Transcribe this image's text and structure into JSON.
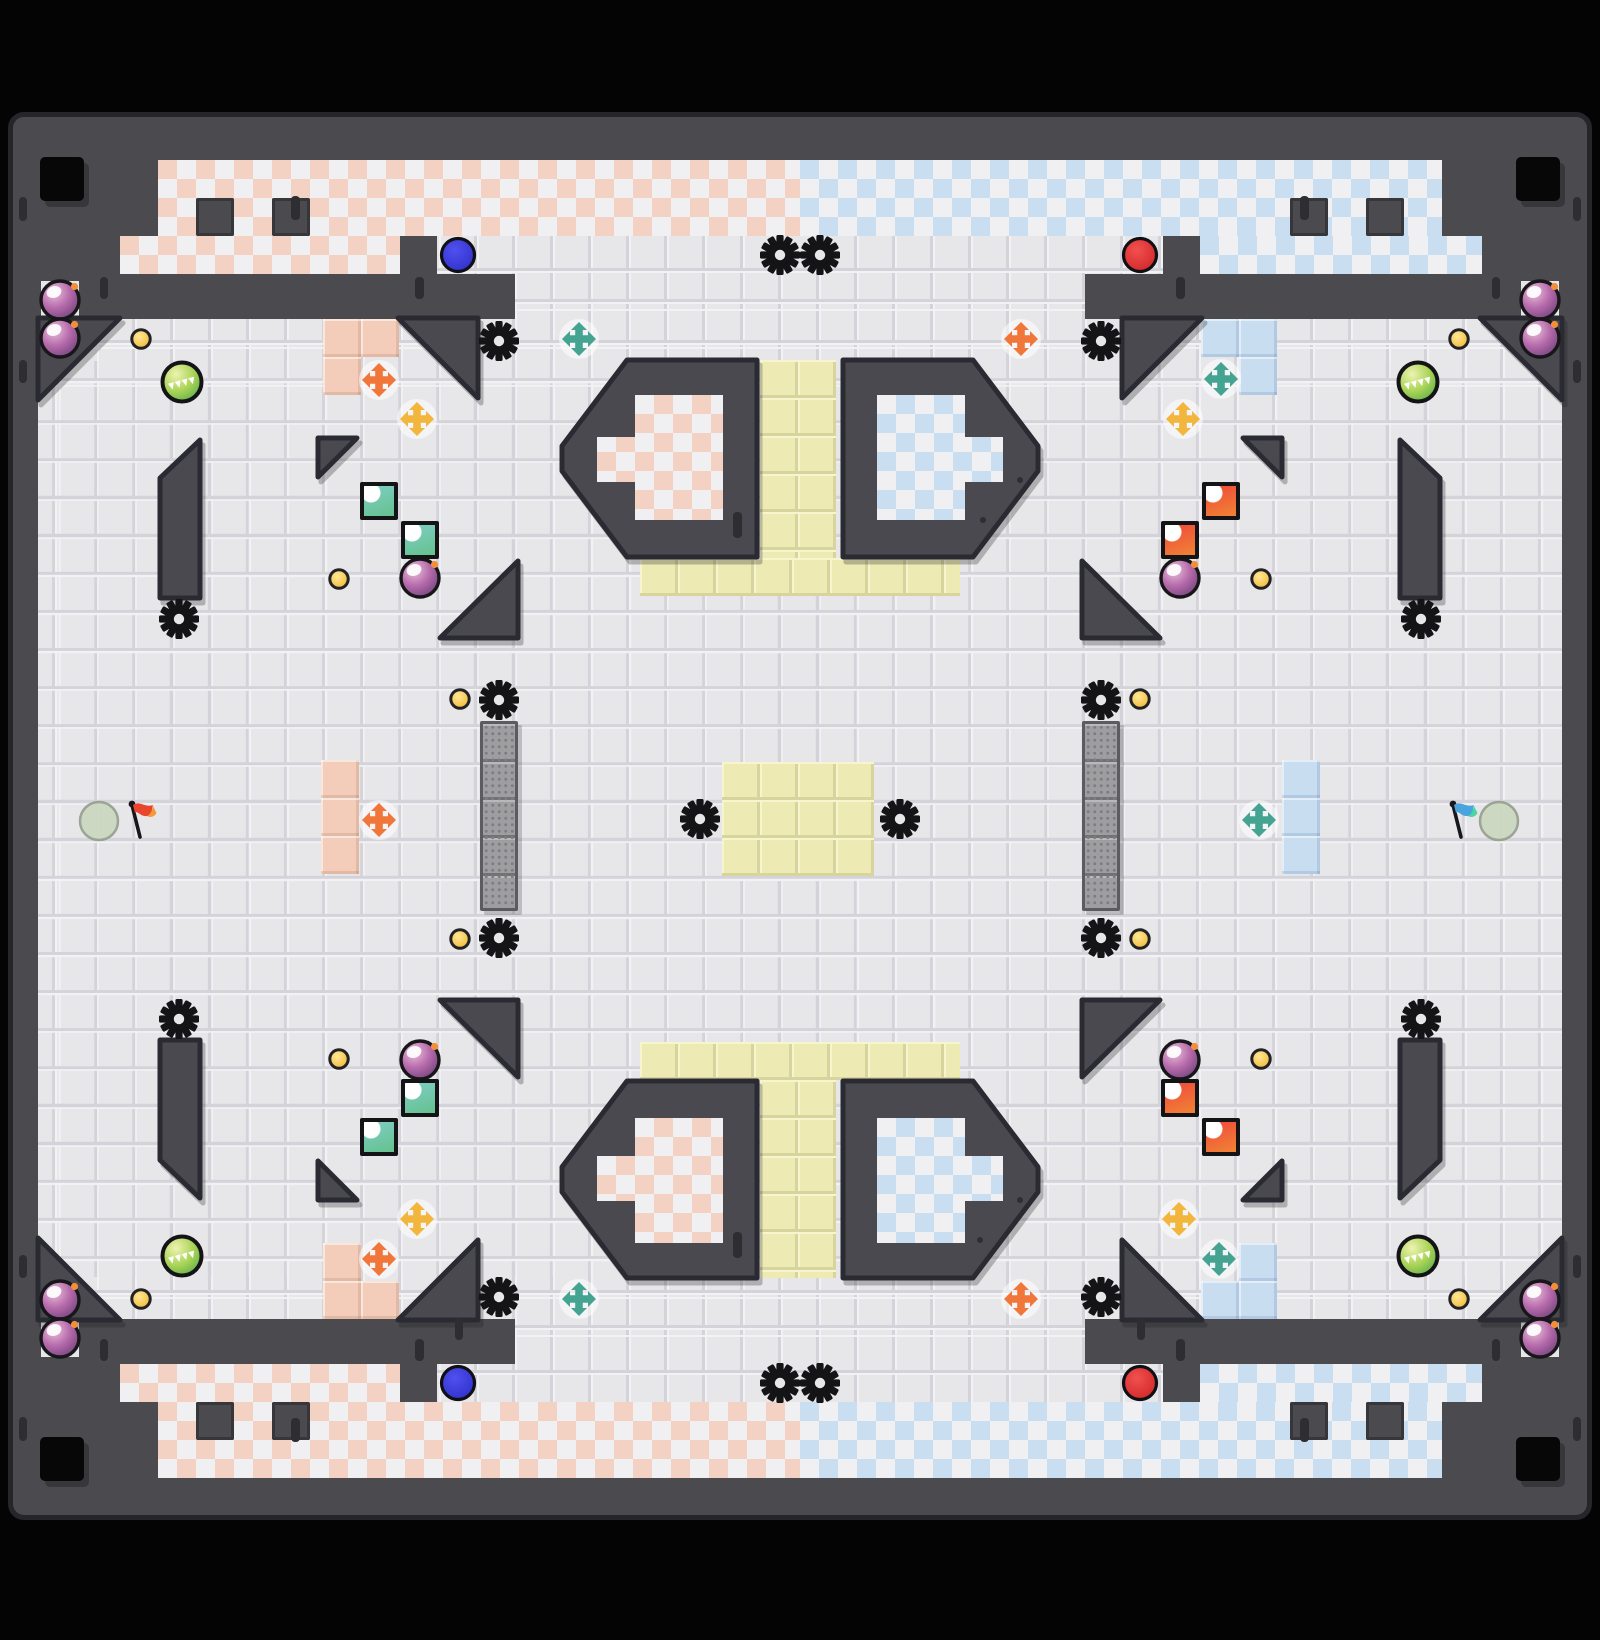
{
  "meta": {
    "app": "tile-arena-game-map",
    "canvas_w": 1600,
    "canvas_h": 1640
  },
  "palette": {
    "background": "#040404",
    "wall": "#4a4a4f",
    "wall_edge": "#2c2c31",
    "floor": "#e7e7ea",
    "checker_pink": "#f3d2c3",
    "checker_blue": "#cadef1",
    "solid_pink": "#f3cdb9",
    "solid_blue": "#c9ddf0",
    "yellow_pad": "#edeab3",
    "gate_gray": "#9e9ea1",
    "portal_blue": "#3a3ad6",
    "portal_red": "#e22b2b",
    "boost_orange": "#f0763a",
    "boost_yellow": "#f2b63c",
    "boost_teal": "#45a392",
    "bomb_purple": "#a05fa0",
    "button_yellow": "#f3b82d",
    "powerup_green": "#58b54a",
    "flag_red": "#e8452c",
    "flag_blue": "#4aa4dd",
    "spawn_pale": "#ccd8c0"
  },
  "frame": {
    "x": 8,
    "y": 112,
    "w": 1584,
    "h": 1408
  },
  "floors": [
    [
      437,
      236,
      726,
      38
    ],
    [
      515,
      274,
      570,
      45
    ],
    [
      80,
      319,
      1440,
      42
    ],
    [
      38,
      361,
      1524,
      916
    ],
    [
      80,
      1277,
      1440,
      42
    ],
    [
      515,
      1319,
      570,
      45
    ],
    [
      437,
      1364,
      726,
      38
    ],
    [
      41,
      281,
      38,
      76
    ],
    [
      1521,
      281,
      38,
      76
    ],
    [
      41,
      1281,
      38,
      76
    ],
    [
      1521,
      1281,
      38,
      76
    ]
  ],
  "checker_pink": [
    [
      158,
      160,
      642,
      76
    ],
    [
      120,
      236,
      280,
      38
    ],
    [
      158,
      1402,
      642,
      76
    ],
    [
      120,
      1364,
      280,
      38
    ]
  ],
  "checker_blue": [
    [
      800,
      160,
      642,
      76
    ],
    [
      1200,
      236,
      282,
      38
    ],
    [
      800,
      1402,
      642,
      76
    ],
    [
      1200,
      1364,
      282,
      38
    ]
  ],
  "band_holes": [
    [
      196,
      198
    ],
    [
      272,
      198
    ],
    [
      1290,
      198
    ],
    [
      1366,
      198
    ],
    [
      196,
      1402
    ],
    [
      272,
      1402
    ],
    [
      1290,
      1402
    ],
    [
      1366,
      1402
    ]
  ],
  "solid_pink": [
    [
      323,
      319,
      76,
      38
    ],
    [
      323,
      357,
      38,
      38
    ],
    [
      321,
      760,
      38,
      114
    ],
    [
      323,
      1281,
      76,
      38
    ],
    [
      323,
      1243,
      38,
      38
    ]
  ],
  "solid_blue": [
    [
      1201,
      319,
      76,
      38
    ],
    [
      1239,
      357,
      38,
      38
    ],
    [
      1282,
      760,
      38,
      114
    ],
    [
      1201,
      1281,
      76,
      38
    ],
    [
      1239,
      1243,
      38,
      38
    ]
  ],
  "yellow_pads": [
    [
      760,
      360,
      76,
      198
    ],
    [
      640,
      558,
      320,
      38
    ],
    [
      722,
      762,
      152,
      114
    ],
    [
      640,
      1042,
      320,
      38
    ],
    [
      760,
      1080,
      76,
      198
    ]
  ],
  "gray_gates": [
    [
      480,
      721,
      38,
      190
    ],
    [
      1082,
      721,
      38,
      190
    ]
  ],
  "corner_squares": [
    [
      40,
      157
    ],
    [
      1516,
      157
    ],
    [
      40,
      1437
    ],
    [
      1516,
      1437
    ]
  ],
  "wall_shapes": [
    {
      "name": "hexagon-top-left",
      "d": "M627,360 L757,360 L757,557 L627,557 L562,471 L562,446 Z"
    },
    {
      "name": "hexagon-top-right",
      "d": "M973,360 L843,360 L843,557 L973,557 L1038,471 L1038,446 Z"
    },
    {
      "name": "hexagon-bottom-left",
      "d": "M627,1278 L757,1278 L757,1081 L627,1081 L562,1167 L562,1192 Z"
    },
    {
      "name": "hexagon-bottom-right",
      "d": "M973,1278 L843,1278 L843,1081 L973,1081 L1038,1167 L1038,1192 Z"
    },
    {
      "name": "pillar-top-left",
      "d": "M160,478 L200,440 L200,598 L160,598 Z"
    },
    {
      "name": "pillar-top-right",
      "d": "M1440,478 L1400,440 L1400,598 L1440,598 Z"
    },
    {
      "name": "pillar-bottom-left",
      "d": "M160,1160 L200,1198 L200,1040 L160,1040 Z"
    },
    {
      "name": "pillar-bottom-right",
      "d": "M1440,1160 L1400,1198 L1400,1040 L1440,1040 Z"
    },
    {
      "name": "wedge-corridor-top-left",
      "d": "M398,318 L478,318 L478,398 Z"
    },
    {
      "name": "wedge-corridor-top-right",
      "d": "M1202,318 L1122,318 L1122,398 Z"
    },
    {
      "name": "wedge-corridor-bottom-left",
      "d": "M398,1320 L478,1320 L478,1240 Z"
    },
    {
      "name": "wedge-corridor-bottom-right",
      "d": "M1202,1320 L1122,1320 L1122,1240 Z"
    },
    {
      "name": "wedge-stair-large-top-left",
      "d": "M440,638 L518,561 L518,638 Z"
    },
    {
      "name": "wedge-stair-large-top-right",
      "d": "M1160,638 L1082,561 L1082,638 Z"
    },
    {
      "name": "wedge-stair-large-bottom-left",
      "d": "M440,1000 L518,1077 L518,1000 Z"
    },
    {
      "name": "wedge-stair-large-bottom-right",
      "d": "M1160,1000 L1082,1077 L1082,1000 Z"
    },
    {
      "name": "wedge-stair-small-top-left",
      "d": "M318,438 L357,438 L318,477 Z"
    },
    {
      "name": "wedge-stair-small-top-right",
      "d": "M1282,438 L1243,438 L1282,477 Z"
    },
    {
      "name": "wedge-stair-small-bottom-left",
      "d": "M318,1200 L318,1161 L357,1200 Z"
    },
    {
      "name": "wedge-stair-small-bottom-right",
      "d": "M1282,1200 L1282,1161 L1243,1200 Z"
    },
    {
      "name": "corner-diagonal-top-left",
      "d": "M38,318 L120,318 L38,400 Z"
    },
    {
      "name": "corner-diagonal-top-right",
      "d": "M1562,318 L1480,318 L1562,400 Z"
    },
    {
      "name": "corner-diagonal-bottom-left",
      "d": "M38,1320 L120,1320 L38,1238 Z"
    },
    {
      "name": "corner-diagonal-bottom-right",
      "d": "M1562,1320 L1480,1320 L1562,1238 Z"
    }
  ],
  "hex_interiors": [
    {
      "x": 597,
      "y": 395,
      "w": 126,
      "h": 125,
      "team": "pink",
      "poly": "38,0 126,0 126,125 38,125 38,87 0,87 0,42 38,42"
    },
    {
      "x": 877,
      "y": 395,
      "w": 126,
      "h": 125,
      "team": "blue",
      "poly": "0,0 88,0 88,42 126,42 126,87 88,87 88,125 0,125"
    },
    {
      "x": 597,
      "y": 1118,
      "w": 126,
      "h": 125,
      "team": "pink",
      "poly": "38,0 126,0 126,125 38,125 38,83 0,83 0,38 38,38"
    },
    {
      "x": 877,
      "y": 1118,
      "w": 126,
      "h": 125,
      "team": "blue",
      "poly": "0,0 88,0 88,38 126,38 126,83 88,83 88,125 0,125"
    }
  ],
  "ticks": [
    [
      291,
      196,
      9,
      24
    ],
    [
      1300,
      196,
      9,
      24
    ],
    [
      291,
      1418,
      9,
      24
    ],
    [
      1300,
      1418,
      9,
      24
    ],
    [
      415,
      277,
      9,
      22
    ],
    [
      1176,
      277,
      9,
      22
    ],
    [
      415,
      1339,
      9,
      22
    ],
    [
      1176,
      1339,
      9,
      22
    ],
    [
      19,
      197,
      8,
      24
    ],
    [
      1573,
      197,
      8,
      24
    ],
    [
      19,
      1417,
      8,
      24
    ],
    [
      1573,
      1417,
      8,
      24
    ],
    [
      100,
      277,
      8,
      22
    ],
    [
      1492,
      277,
      8,
      22
    ],
    [
      100,
      1339,
      8,
      22
    ],
    [
      1492,
      1339,
      8,
      22
    ],
    [
      19,
      360,
      8,
      23
    ],
    [
      1573,
      360,
      8,
      23
    ],
    [
      19,
      1255,
      8,
      23
    ],
    [
      1573,
      1255,
      8,
      23
    ],
    [
      455,
      1318,
      8,
      22
    ],
    [
      1137,
      1318,
      8,
      22
    ],
    [
      733,
      512,
      9,
      26
    ],
    [
      733,
      1232,
      9,
      26
    ]
  ],
  "wall_dots": [
    [
      1017,
      477
    ],
    [
      980,
      517
    ],
    [
      1017,
      1197
    ],
    [
      977,
      1237
    ]
  ],
  "objects": {
    "portals": [
      {
        "x": 458,
        "y": 255,
        "color": "blue"
      },
      {
        "x": 1140,
        "y": 255,
        "color": "red"
      },
      {
        "x": 458,
        "y": 1383,
        "color": "blue"
      },
      {
        "x": 1140,
        "y": 1383,
        "color": "red"
      }
    ],
    "gears": [
      [
        780,
        255
      ],
      [
        820,
        255
      ],
      [
        499,
        341
      ],
      [
        1101,
        341
      ],
      [
        179,
        619
      ],
      [
        1421,
        619
      ],
      [
        499,
        700
      ],
      [
        1101,
        700
      ],
      [
        700,
        819
      ],
      [
        900,
        819
      ],
      [
        499,
        938
      ],
      [
        1101,
        938
      ],
      [
        179,
        1019
      ],
      [
        1421,
        1019
      ],
      [
        499,
        1297
      ],
      [
        1101,
        1297
      ],
      [
        780,
        1383
      ],
      [
        820,
        1383
      ]
    ],
    "bombs": [
      [
        60,
        300
      ],
      [
        60,
        338
      ],
      [
        1540,
        300
      ],
      [
        1540,
        338
      ],
      [
        420,
        578
      ],
      [
        1180,
        578
      ],
      [
        420,
        1060
      ],
      [
        1180,
        1060
      ],
      [
        60,
        1300
      ],
      [
        60,
        1338
      ],
      [
        1540,
        1300
      ],
      [
        1540,
        1338
      ]
    ],
    "buttons": [
      [
        141,
        339
      ],
      [
        1459,
        339
      ],
      [
        339,
        579
      ],
      [
        1261,
        579
      ],
      [
        460,
        699
      ],
      [
        1140,
        699
      ],
      [
        460,
        939
      ],
      [
        1140,
        939
      ],
      [
        339,
        1059
      ],
      [
        1261,
        1059
      ],
      [
        141,
        1299
      ],
      [
        1459,
        1299
      ]
    ],
    "boosts": [
      {
        "x": 579,
        "y": 339,
        "color": "teal"
      },
      {
        "x": 1021,
        "y": 339,
        "color": "orange"
      },
      {
        "x": 379,
        "y": 380,
        "color": "orange"
      },
      {
        "x": 1221,
        "y": 379,
        "color": "teal"
      },
      {
        "x": 417,
        "y": 419,
        "color": "yellow"
      },
      {
        "x": 1183,
        "y": 419,
        "color": "yellow"
      },
      {
        "x": 379,
        "y": 820,
        "color": "orange"
      },
      {
        "x": 1259,
        "y": 820,
        "color": "teal"
      },
      {
        "x": 417,
        "y": 1219,
        "color": "yellow"
      },
      {
        "x": 1179,
        "y": 1219,
        "color": "yellow"
      },
      {
        "x": 379,
        "y": 1259,
        "color": "orange"
      },
      {
        "x": 1219,
        "y": 1259,
        "color": "teal"
      },
      {
        "x": 579,
        "y": 1299,
        "color": "teal"
      },
      {
        "x": 1021,
        "y": 1299,
        "color": "orange"
      }
    ],
    "powerups": [
      [
        182,
        382
      ],
      [
        1418,
        382
      ],
      [
        182,
        1256
      ],
      [
        1418,
        1256
      ]
    ],
    "gate_tiles": [
      {
        "x": 360,
        "y": 482,
        "color": "teal"
      },
      {
        "x": 401,
        "y": 521,
        "color": "teal"
      },
      {
        "x": 1202,
        "y": 482,
        "color": "red"
      },
      {
        "x": 1161,
        "y": 521,
        "color": "red"
      },
      {
        "x": 401,
        "y": 1079,
        "color": "teal"
      },
      {
        "x": 360,
        "y": 1118,
        "color": "teal"
      },
      {
        "x": 1161,
        "y": 1079,
        "color": "red"
      },
      {
        "x": 1202,
        "y": 1118,
        "color": "red"
      }
    ],
    "flags": [
      {
        "x": 137,
        "y": 818,
        "team": "red"
      },
      {
        "x": 1458,
        "y": 818,
        "team": "blue"
      }
    ],
    "spawns": [
      [
        99,
        821
      ],
      [
        1499,
        821
      ]
    ]
  }
}
